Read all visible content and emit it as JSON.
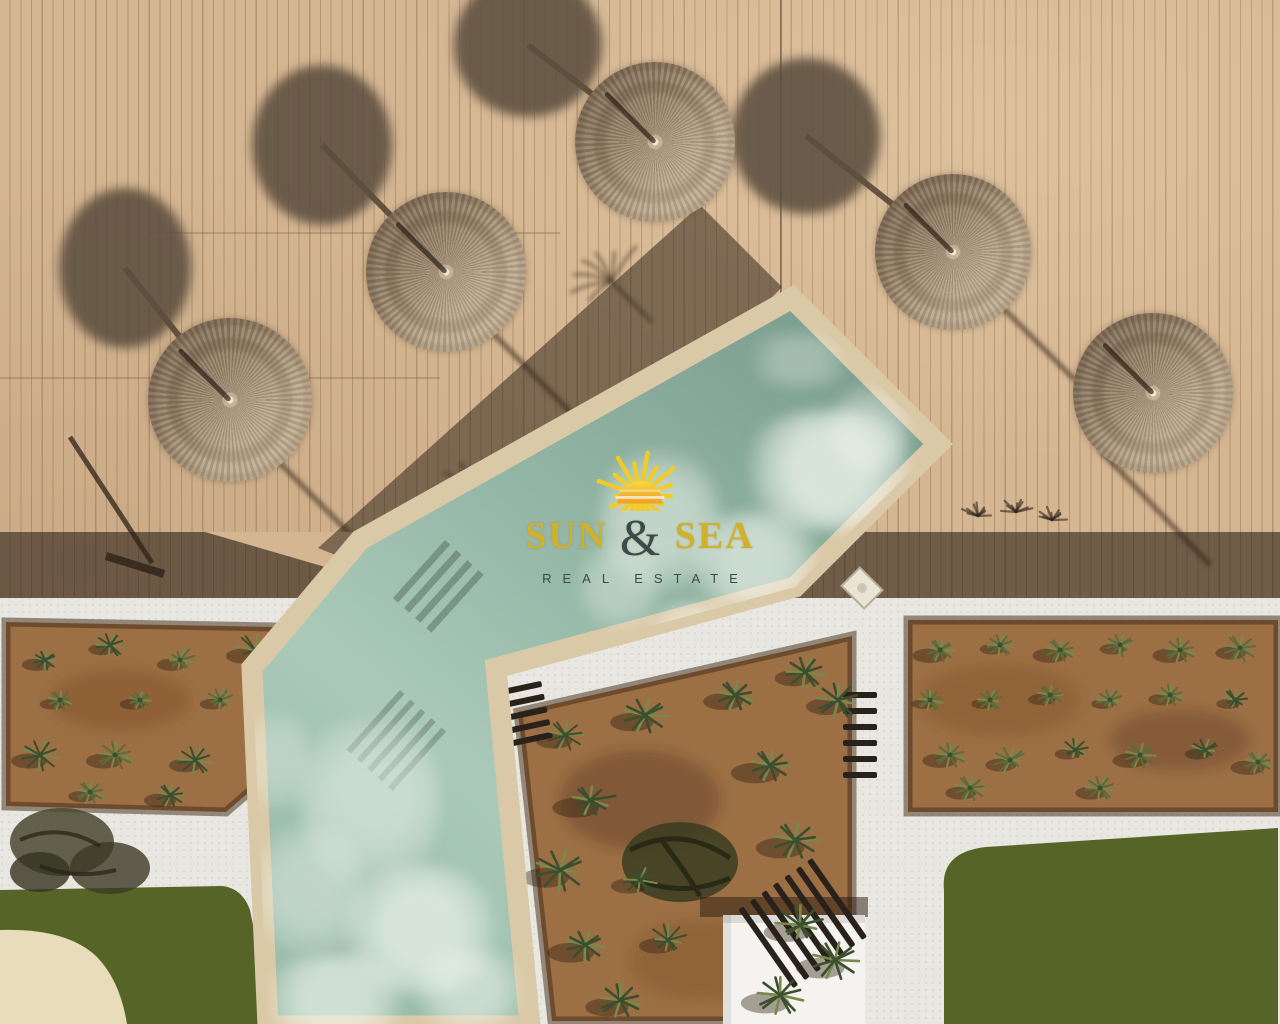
{
  "watermark": {
    "brand_part1": "SUN",
    "brand_amp": "&",
    "brand_part2": "SEA",
    "subtitle": "REAL ESTATE",
    "icon": "sun-icon"
  },
  "palette": {
    "deck": "#d5b692",
    "deck_line": "#b89b76",
    "dk_shadow": "rgba(44,33,24,0.60)",
    "band_shadow": "rgba(52,40,29,0.55)",
    "u_shadow": "rgba(92,78,64,0.88)",
    "straw": "#b5a287",
    "straw_d": "#94806a",
    "water_deep": "#7c9e90",
    "water_light": "#aac9b9",
    "coping": "#dac9a7",
    "path": "#e9e7e1",
    "soil": "#9c6f45",
    "plant_dark": "#3b4f2e",
    "plant_mid": "#5a6d3b",
    "plant_light": "#78894c",
    "lawn": "#566428",
    "sand": "#e8dcba",
    "shed": "#f4f3ef",
    "lounger": "#29221b",
    "logo_gold": "#d0b02c",
    "logo_dark": "#3c4a4a",
    "sun_yellow": "#f2cb25",
    "sun_orange": "#ef9f2b"
  }
}
